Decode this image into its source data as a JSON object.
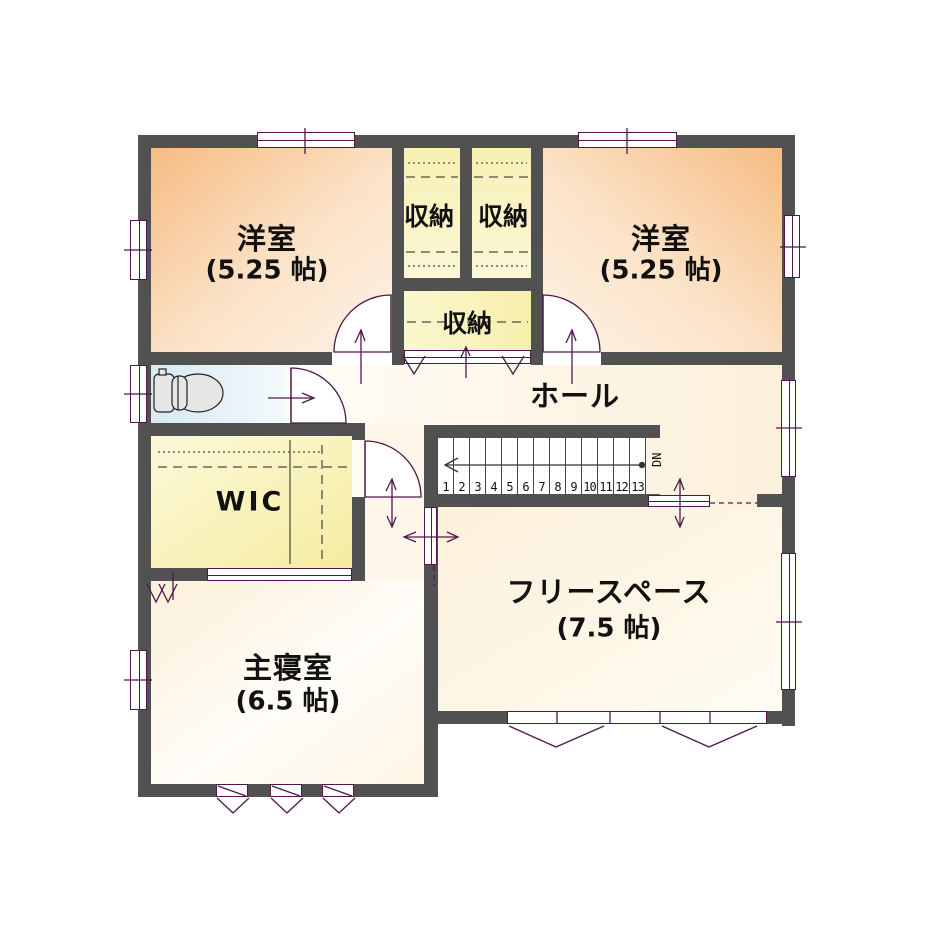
{
  "plan": {
    "rooms": {
      "western_room_left": {
        "label": "洋室",
        "area": "(5.25 帖)"
      },
      "western_room_right": {
        "label": "洋室",
        "area": "(5.25 帖)"
      },
      "closet_top_left": {
        "label": "収納"
      },
      "closet_top_right": {
        "label": "収納"
      },
      "closet_hall": {
        "label": "収納"
      },
      "hall": {
        "label": "ホール"
      },
      "walk_in_closet": {
        "label": "WIC"
      },
      "master_bedroom": {
        "label": "主寝室",
        "area": "(6.5 帖)"
      },
      "free_space": {
        "label": "フリースペース",
        "area": "(7.5 帖)"
      }
    },
    "stairs": {
      "steps": [
        "1",
        "2",
        "3",
        "4",
        "5",
        "6",
        "7",
        "8",
        "9",
        "10",
        "11",
        "12",
        "13"
      ],
      "direction": "DN"
    },
    "colors": {
      "wall": "#515151",
      "line": "#4f184d",
      "room_orange": "#f7bf87",
      "closet_yellow": "#f6edb2",
      "toilet_blue": "#d9eaf2",
      "cream": "#fbf0da"
    }
  }
}
